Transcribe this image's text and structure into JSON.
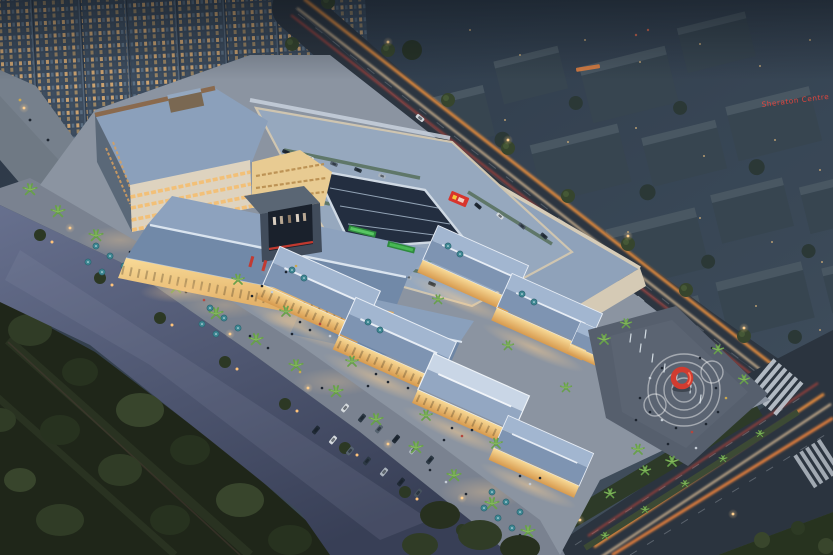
{
  "scene": {
    "description": "Aerial dusk rendering of a riverside open-air shopping mall: warmly lit retail streets and pavilions, rooftop parking deck with long skylight, cinema media screen, entrance plaza with red ring sculpture and fountain, waterfront promenade with palm trees and teal umbrellas beside a river and dark park; residential towers upper-left; dusk-blue city blocks and avenues with car light trails to the right.",
    "time_of_day": "dusk"
  },
  "signs": {
    "sheraton": "Sheraton Centre"
  },
  "palette": {
    "dusk_base": "#33404f",
    "city_block": "#49565f",
    "residential_tower": "#3b4a5c",
    "window_warm": "#e2b170",
    "road_asphalt": "#2c3540",
    "light_trail_orange": "#f4933f",
    "light_trail_red": "#e2483a",
    "river": "#4e5775",
    "park_green": "#222b1c",
    "mall_roof_blue": "#93a7c2",
    "roof_ridge_white": "#e8eef6",
    "cream_wall": "#d6ccb8",
    "storefront_warm": "#f0c179",
    "palm_green": "#68a04b",
    "umbrella_teal": "#3e8793",
    "led_green": "#37a34a",
    "sculpture_red": "#d13c30",
    "paving": "#8b94a1",
    "plaza_paving": "#58616f"
  },
  "features": [
    "residential high-rise towers",
    "Sheraton Centre red neon sign",
    "avenue with car light trails",
    "rooftop parking deck with ridge skylight",
    "cinema media screen with red banners",
    "green LED fascia signs",
    "retail pavilions with hipped blue roofs",
    "waterfront promenade with palms, umbrellas and parked cars",
    "river with bank lights",
    "urban park with tree canopy and paths",
    "entrance plaza with red ring sculpture, ground rings and fountain jets",
    "zebra crossings at road intersection"
  ]
}
